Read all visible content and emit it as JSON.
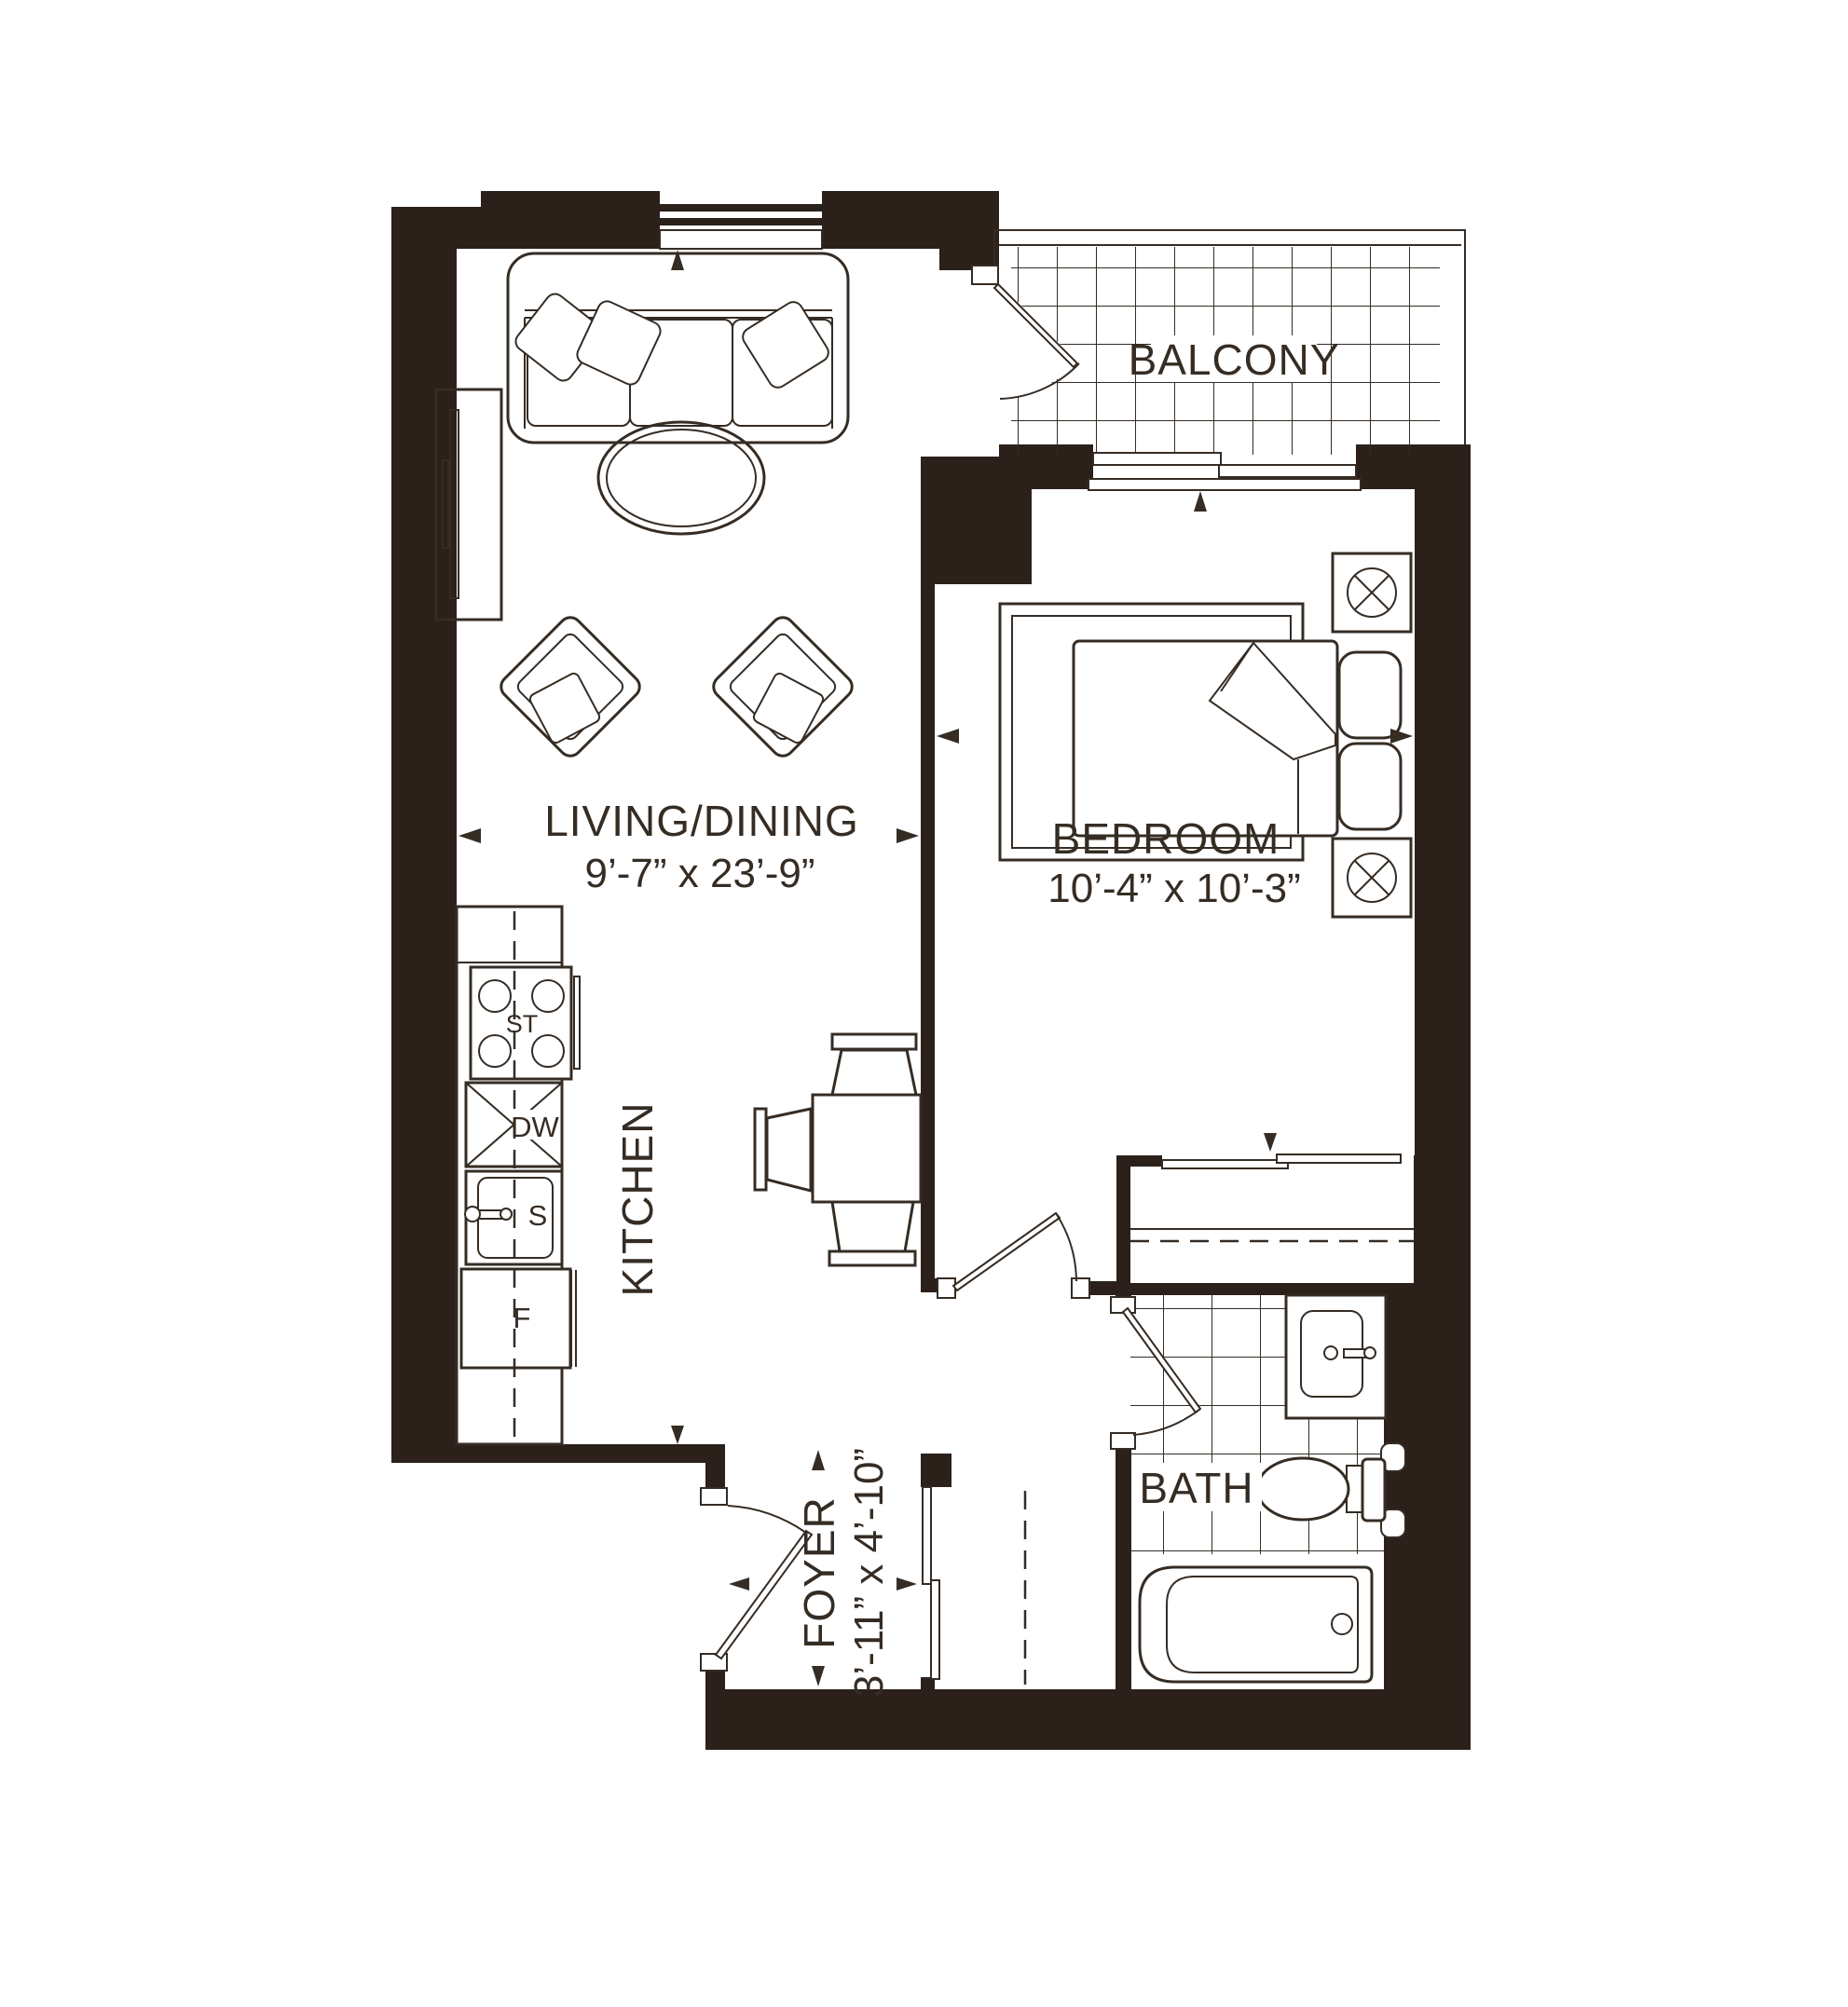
{
  "document": {
    "type": "apartment-floor-plan"
  },
  "colors": {
    "wall": "#2b211a",
    "line": "#352c24",
    "background": "#ffffff"
  },
  "rooms": {
    "balcony": {
      "label": "BALCONY"
    },
    "living_dining": {
      "label": "LIVING/DINING",
      "dims": "9’-7” x 23’-9”"
    },
    "bedroom": {
      "label": "BEDROOM",
      "dims": "10’-4” x 10’-3”"
    },
    "kitchen": {
      "label": "KITCHEN"
    },
    "bath": {
      "label": "BATH"
    },
    "foyer": {
      "label": "FOYER",
      "dims": "3’-11” x 4’-10”"
    }
  },
  "appliances": {
    "stove": "ST",
    "dishwasher": "DW",
    "sink": "S",
    "fridge": "F"
  }
}
